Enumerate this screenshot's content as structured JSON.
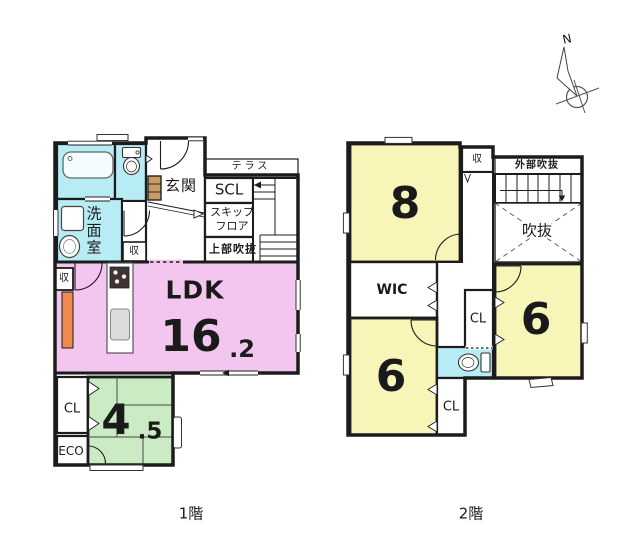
{
  "colors": {
    "ldk_pink": "#F3C6EF",
    "room_yellow": "#F8F5B8",
    "tatami_green": "#CBEBC5",
    "water_cyan": "#B7ECF4",
    "accent_orange": "#F0894E",
    "cabinet_tan": "#C89B62",
    "wall_black": "#1C1C1C"
  },
  "compass": {
    "north_label": "N"
  },
  "floor1": {
    "caption": "1階",
    "terrace": {
      "label": "テラス"
    },
    "entrance": {
      "label": "玄関"
    },
    "shoe_closet": {
      "label": "SCL"
    },
    "skip_floor": {
      "line1": "スキップ",
      "line2": "フロア"
    },
    "upper_void": {
      "label": "上部吹抜"
    },
    "washroom": {
      "label": "洗面室"
    },
    "hall_storage": {
      "label": "収"
    },
    "ldk_storage": {
      "label": "収"
    },
    "ldk": {
      "label": "LDK",
      "area_int": "16",
      "area_dec": ".2"
    },
    "closet": {
      "label": "CL"
    },
    "eco": {
      "label": "ECO"
    },
    "tatami": {
      "area_int": "4",
      "area_dec": ".5"
    }
  },
  "floor2": {
    "caption": "2階",
    "bedroom8": {
      "area": "8"
    },
    "storage": {
      "label": "収"
    },
    "outer_void": {
      "label": "外部吹抜"
    },
    "void": {
      "label": "吹抜"
    },
    "wic": {
      "label": "WIC"
    },
    "closet_mid": {
      "label": "CL"
    },
    "closet_bottom": {
      "label": "CL"
    },
    "bedroom6_left": {
      "area": "6"
    },
    "bedroom6_right": {
      "area": "6"
    }
  }
}
